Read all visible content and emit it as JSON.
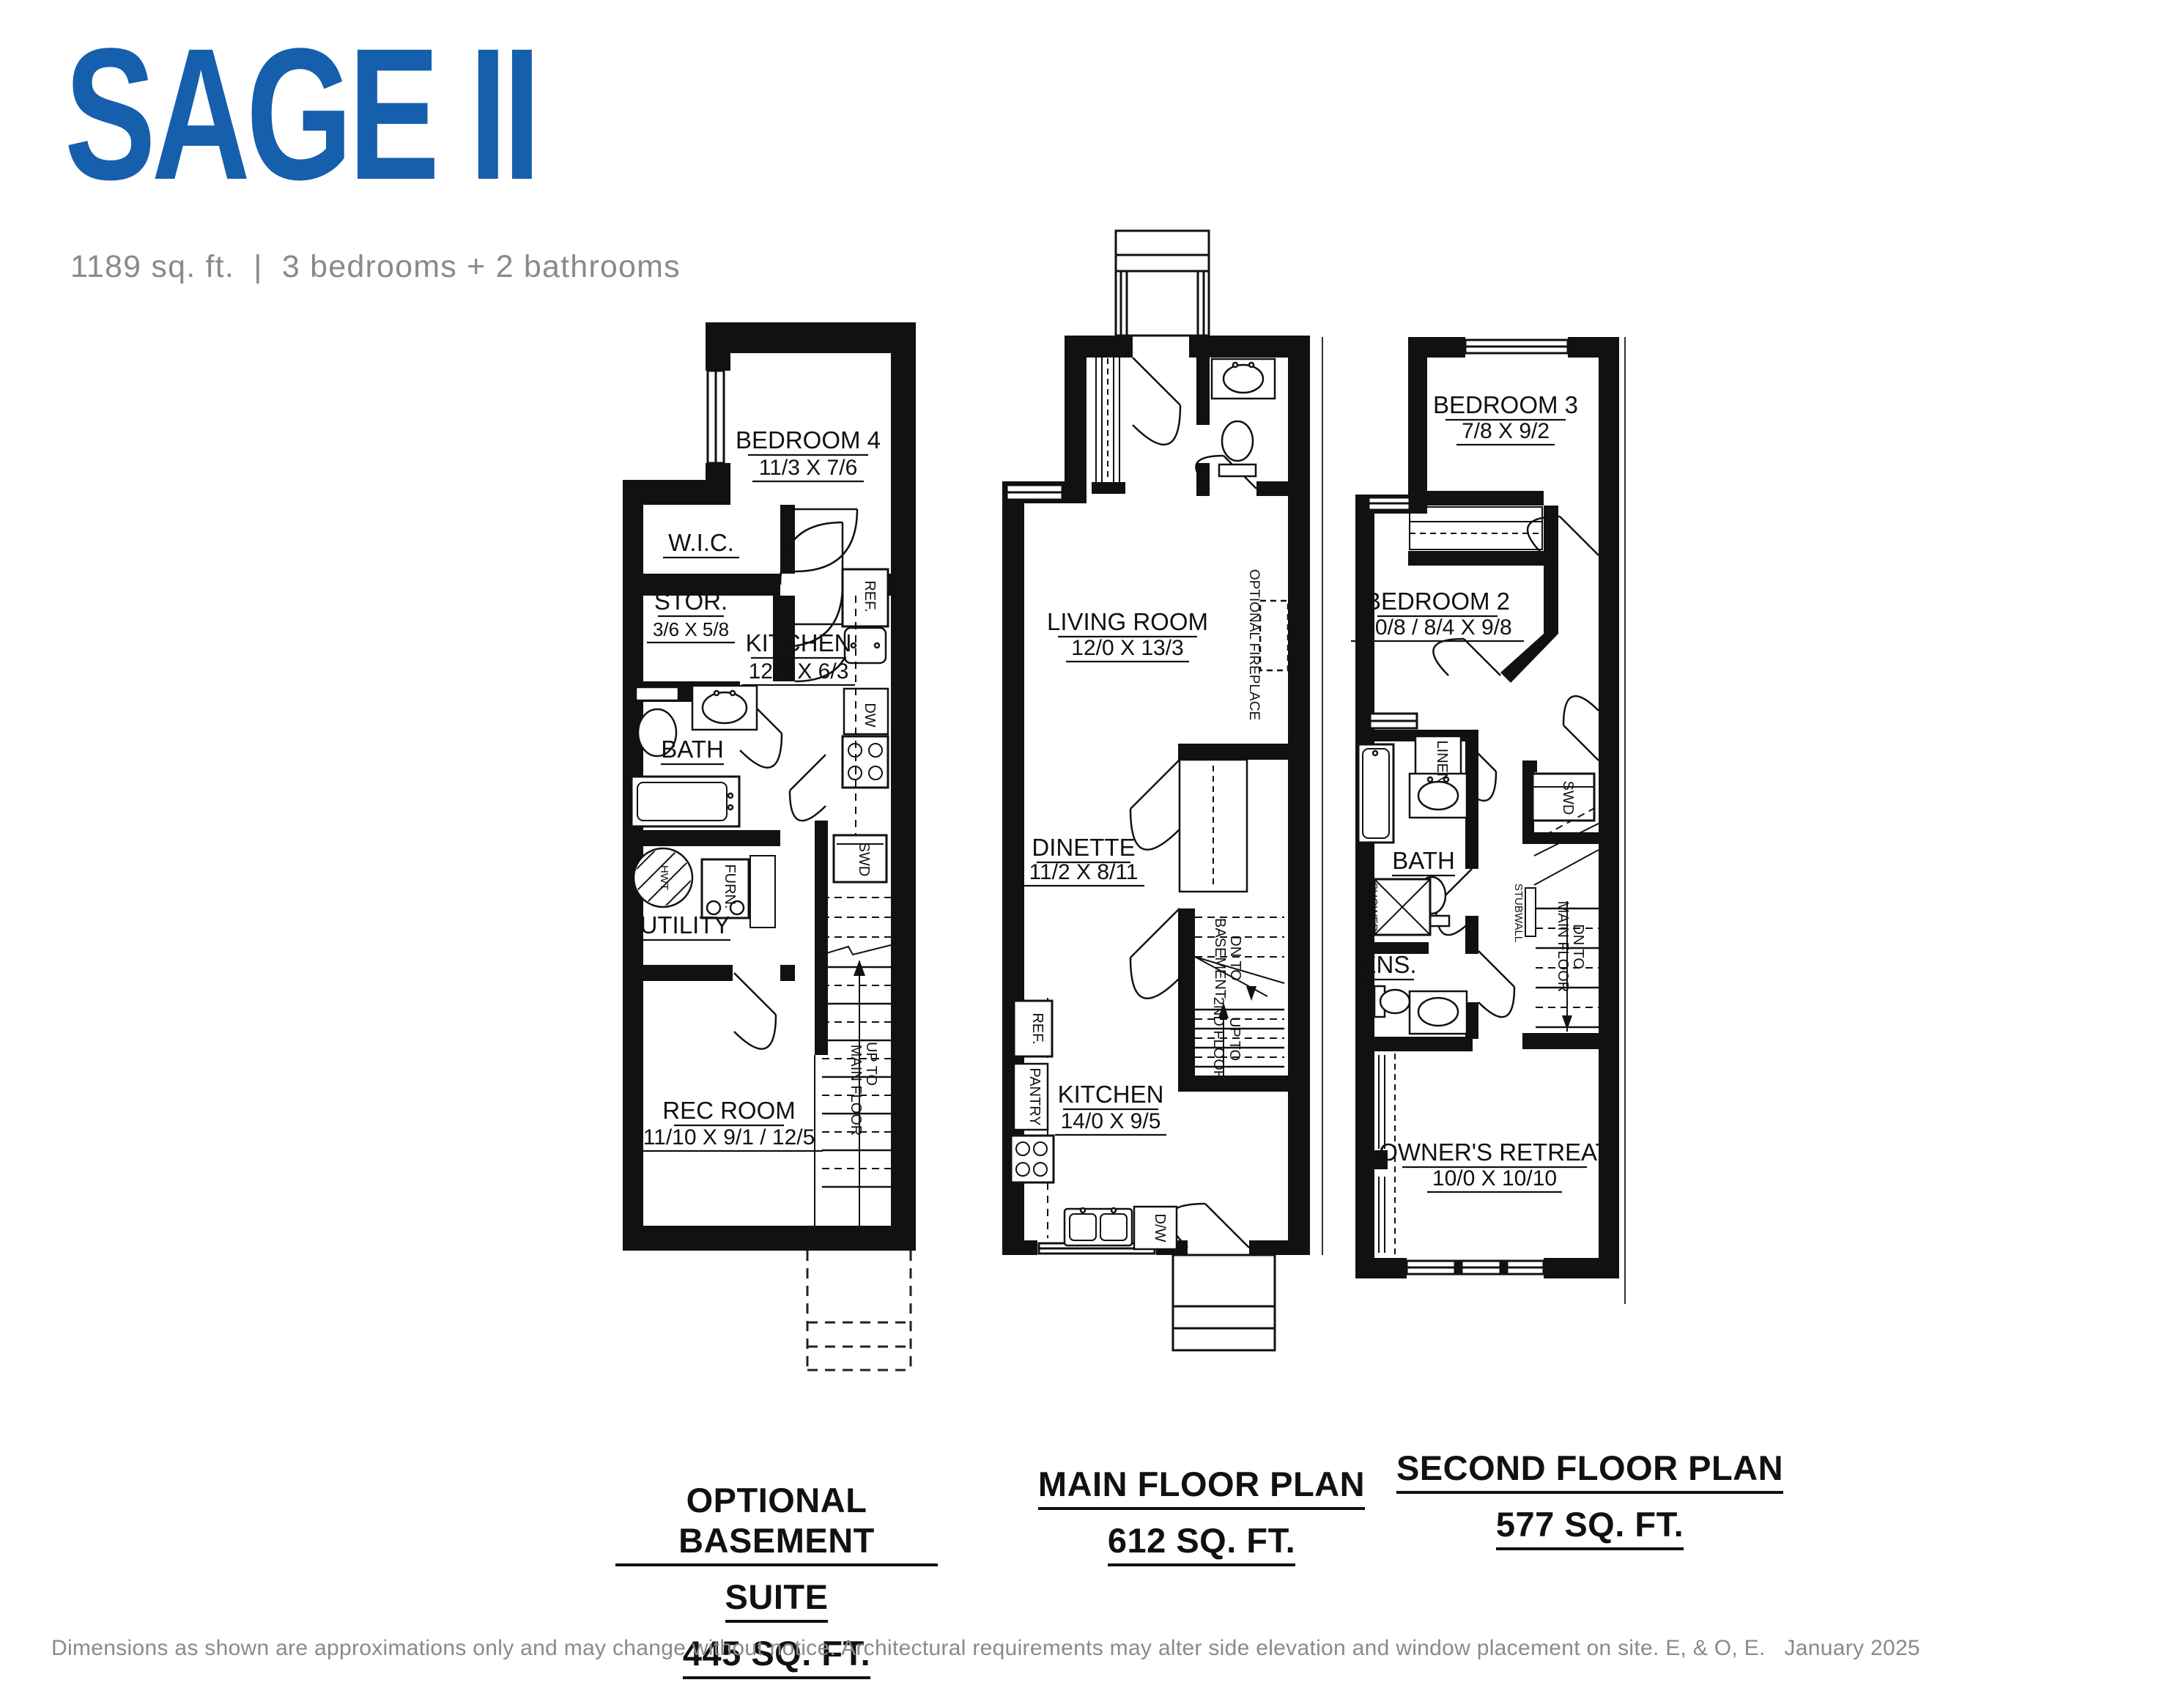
{
  "header": {
    "title": "SAGE II",
    "subtitle": "1189 sq. ft.  |  3 bedrooms + 2 bathrooms"
  },
  "colors": {
    "brand_blue": "#155FAD",
    "subtitle_gray": "#8A8A8A",
    "plan_line": "#111111",
    "disclaimer_gray": "#8A8A8A"
  },
  "plans": {
    "basement": {
      "rooms": {
        "bedroom4": {
          "name": "BEDROOM 4",
          "dim": "11/3 X 7/6"
        },
        "wic": {
          "name": "W.I.C."
        },
        "stor": {
          "name": "STOR.",
          "dim": "3/6 X 5/8"
        },
        "kitchen": {
          "name": "KITCHEN",
          "dim": "12/1 X 6/3"
        },
        "bath": {
          "name": "BATH"
        },
        "utility": {
          "name": "UTILITY"
        },
        "rec": {
          "name": "REC ROOM",
          "dim": "11/10 X 9/1 / 12/5"
        }
      },
      "fixtures": {
        "ref": "REF.",
        "dw": "DW",
        "swd": "SWD",
        "furn": "FURN.",
        "hwt": "HWT"
      },
      "stairs": {
        "l1": "UP TO",
        "l2": "MAIN FLOOR"
      },
      "caption": {
        "l1": "OPTIONAL BASEMENT",
        "l2": "SUITE",
        "l3": "445 SQ. FT."
      }
    },
    "main": {
      "rooms": {
        "living": {
          "name": "LIVING ROOM",
          "dim": "12/0 X 13/3"
        },
        "dinette": {
          "name": "DINETTE",
          "dim": "11/2 X 8/11"
        },
        "kitchen": {
          "name": "KITCHEN",
          "dim": "14/0 X 9/5"
        }
      },
      "fixtures": {
        "ref": "REF.",
        "pantry": "PANTRY",
        "dw": "D/W",
        "fireplace": "OPTIONAL FIREPLACE"
      },
      "stairs_dn": {
        "l1": "DN TO",
        "l2": "BASEMENT"
      },
      "stairs_up": {
        "l1": "UP TO",
        "l2": "2ND FLOOR"
      },
      "caption": {
        "l1": "MAIN FLOOR PLAN",
        "l2": "612 SQ. FT."
      }
    },
    "second": {
      "rooms": {
        "bedroom3": {
          "name": "BEDROOM 3",
          "dim": "7/8 X 9/2"
        },
        "bedroom2": {
          "name": "BEDROOM 2",
          "dim": "10/8 / 8/4 X 9/8"
        },
        "bath": {
          "name": "BATH"
        },
        "ens": {
          "name": "ENS."
        },
        "owners": {
          "name": "OWNER'S RETREAT",
          "dim": "10/0 X 10/10"
        }
      },
      "fixtures": {
        "linen": "LINEN",
        "swd": "SWD",
        "shower": "SHOWER",
        "stubwall": "STUBWALL"
      },
      "stairs": {
        "l1": "DN TO",
        "l2": "MAIN FLOOR"
      },
      "caption": {
        "l1": "SECOND FLOOR PLAN",
        "l2": "577 SQ. FT."
      }
    }
  },
  "footer": {
    "disclaimer": "Dimensions as shown are approximations only and may change without notice. Architectural requirements may alter side elevation and window placement on site. E, & O, E.   January 2025"
  }
}
